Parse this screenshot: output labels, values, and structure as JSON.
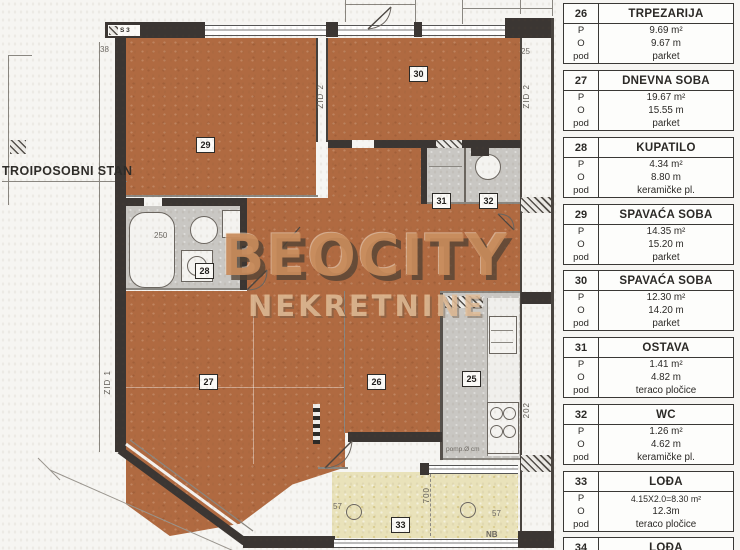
{
  "title_label": "TROIPOSOBNI STAN",
  "watermark": {
    "line1": "BEOCITY",
    "line2": "NEKRETNINE"
  },
  "plan": {
    "small_texts": {
      "s3": "S 3",
      "dim38": "38",
      "dim25": "25",
      "dim250": "250",
      "dim700": "700",
      "dim57a": "57",
      "dim57b": "57",
      "nb": "NB",
      "pomp": "pomp.Ø cm",
      "zid2a": "ZID 2",
      "zid2b": "ZID 2",
      "dim202": "202",
      "zid1": "ZID 1"
    },
    "markers": [
      "25",
      "26",
      "27",
      "28",
      "29",
      "30",
      "31",
      "32",
      "33"
    ]
  },
  "legend": {
    "labels": {
      "p": "P",
      "o": "O",
      "pod": "pod"
    },
    "rows": [
      {
        "num": "26",
        "name": "TRPEZARIJA",
        "p": "9.69 m²",
        "o": "9.67 m",
        "pod": "parket"
      },
      {
        "num": "27",
        "name": "DNEVNA SOBA",
        "p": "19.67 m²",
        "o": "15.55 m",
        "pod": "parket"
      },
      {
        "num": "28",
        "name": "KUPATILO",
        "p": "4.34 m²",
        "o": "8.80 m",
        "pod": "keramičke pl."
      },
      {
        "num": "29",
        "name": "SPAVAĆA SOBA",
        "p": "14.35 m²",
        "o": "15.20 m",
        "pod": "parket"
      },
      {
        "num": "30",
        "name": "SPAVAĆA SOBA",
        "p": "12.30 m²",
        "o": "14.20 m",
        "pod": "parket"
      },
      {
        "num": "31",
        "name": "OSTAVA",
        "p": "1.41 m²",
        "o": "4.82 m",
        "pod": "teraco pločice"
      },
      {
        "num": "32",
        "name": "WC",
        "p": "1.26 m²",
        "o": "4.62 m",
        "pod": "keramičke pl."
      },
      {
        "num": "33",
        "name": "LOĐA",
        "p": "4.15X2.0=8.30 m²",
        "o": "12.3m",
        "pod": "teraco pločice"
      },
      {
        "num": "34",
        "name": "LOĐA"
      }
    ]
  }
}
